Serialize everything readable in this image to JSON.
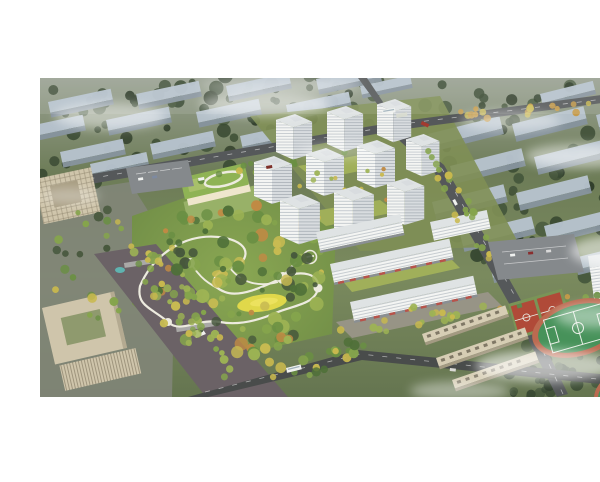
{
  "image": {
    "type": "aerial-architectural-rendering",
    "description": "Bird's-eye architectural rendering of a residential development: a central landscaped park with winding white paths and a yellow lawn, a cluster of white high-rise apartment towers, a kindergarten with a green roof and rooftop oval, mid-rise blocks with ground-floor shops, a school campus with green sports pitch and red courts at lower right, beige office buildings at left, tree-lined boulevards, and hazy rows of existing city blocks fading into mist at the top and right.",
    "render_area": {
      "top_margin_px": 62,
      "bottom_margin_px": 69,
      "width_px": 600,
      "height_px": 319
    }
  },
  "scene": {
    "features": {
      "residential_towers": 10,
      "midrise_shop_blocks": 4,
      "hazy_city_slabs_left": 16,
      "hazy_city_slabs_right": 18,
      "kindergarten": 1,
      "office_buildings": 3,
      "sports_pitches": 2,
      "basketball_courts": 2,
      "school_classroom_blocks": 3,
      "parking_lots": 2,
      "central_park": 1
    },
    "tree_clusters": [
      {
        "name": "haze-left",
        "cx": 160,
        "cy": 112,
        "rx": 185,
        "ry": 52,
        "rot": -8,
        "count": 55,
        "rmin": 3,
        "rmax": 8,
        "colors": [
          "dark_tree_1",
          "dark_tree_2",
          "dark_tree_3"
        ]
      },
      {
        "name": "haze-top",
        "cx": 300,
        "cy": 78,
        "rx": 300,
        "ry": 16,
        "rot": 0,
        "count": 40,
        "rmin": 3,
        "rmax": 7,
        "colors": [
          "dark_tree_1",
          "dark_tree_2",
          "dark_tree_3"
        ]
      },
      {
        "name": "haze-right",
        "cx": 505,
        "cy": 175,
        "rx": 115,
        "ry": 95,
        "rot": 0,
        "count": 60,
        "rmin": 3,
        "rmax": 8,
        "colors": [
          "dark_tree_1",
          "dark_tree_2",
          "dark_tree_3"
        ]
      },
      {
        "name": "corner-bottom-right",
        "cx": 530,
        "cy": 352,
        "rx": 85,
        "ry": 30,
        "rot": -5,
        "count": 32,
        "rmin": 3,
        "rmax": 7,
        "colors": [
          "dark_tree_1",
          "dark_tree_2",
          "dark_tree_3"
        ]
      },
      {
        "name": "park",
        "cx": 196,
        "cy": 262,
        "rx": 92,
        "ry": 78,
        "rot": 0,
        "count": 110,
        "rmin": 2.5,
        "rmax": 7,
        "colors": [
          "park_green_1",
          "park_green_2",
          "park_green_3",
          "park_green_4",
          "park_yellow",
          "park_orange",
          "dark_tree_3"
        ]
      },
      {
        "name": "boulevard",
        "cx": 150,
        "cy": 302,
        "rx": 17,
        "ry": 88,
        "rot": -39,
        "count": 36,
        "rmin": 2.5,
        "rmax": 4.5,
        "colors": [
          "street_tree_yellow",
          "park_green_4",
          "park_green_3"
        ]
      },
      {
        "name": "right-road-trees",
        "cx": 420,
        "cy": 190,
        "rx": 11,
        "ry": 70,
        "rot": -28,
        "count": 22,
        "rmin": 2.5,
        "rmax": 4,
        "colors": [
          "street_tree_yellow",
          "park_green_3"
        ]
      },
      {
        "name": "top-right-road-trees",
        "cx": 485,
        "cy": 95,
        "rx": 85,
        "ry": 7,
        "rot": -4,
        "count": 16,
        "rmin": 2.5,
        "rmax": 4,
        "colors": [
          "street_tree_orange",
          "street_tree_yellow"
        ]
      },
      {
        "name": "shops-street-trees",
        "cx": 370,
        "cy": 302,
        "rx": 78,
        "ry": 10,
        "rot": -11,
        "count": 18,
        "rmin": 2.5,
        "rmax": 4.2,
        "colors": [
          "street_tree_yellow",
          "park_green_4"
        ]
      },
      {
        "name": "site-top-trees",
        "cx": 235,
        "cy": 152,
        "rx": 85,
        "ry": 10,
        "rot": -9,
        "count": 16,
        "rmin": 2.5,
        "rmax": 4,
        "colors": [
          "park_green_3",
          "street_tree_yellow",
          "park_green_2"
        ]
      },
      {
        "name": "courtyard-dots",
        "cx": 305,
        "cy": 176,
        "rx": 55,
        "ry": 28,
        "rot": -10,
        "count": 18,
        "rmin": 1.8,
        "rmax": 3,
        "colors": [
          "street_tree_yellow",
          "park_orange",
          "park_green_4"
        ]
      },
      {
        "name": "plaza-left-trees",
        "cx": 55,
        "cy": 250,
        "rx": 45,
        "ry": 60,
        "rot": 0,
        "count": 24,
        "rmin": 2.5,
        "rmax": 5,
        "colors": [
          "park_green_2",
          "park_green_3",
          "street_tree_yellow",
          "dark_tree_3"
        ]
      },
      {
        "name": "sports-perimeter-trees",
        "cx": 520,
        "cy": 282,
        "rx": 70,
        "ry": 12,
        "rot": -12,
        "count": 14,
        "rmin": 2.5,
        "rmax": 4.5,
        "colors": [
          "park_green_2",
          "park_green_3",
          "street_tree_orange"
        ]
      },
      {
        "name": "bottom-center-trees",
        "cx": 275,
        "cy": 345,
        "rx": 60,
        "ry": 16,
        "rot": -14,
        "count": 20,
        "rmin": 3,
        "rmax": 5.5,
        "colors": [
          "park_green_2",
          "park_green_1",
          "park_green_3",
          "street_tree_yellow"
        ]
      }
    ]
  },
  "palette": {
    "background": "#ffffff",
    "base_top": "#99a192",
    "base_mid": "#6d7c57",
    "base_low": "#7a8a5e",
    "base_deep": "#657550",
    "dark_tree_1": "#3a4a33",
    "dark_tree_2": "#2f3d2a",
    "dark_tree_3": "#46573c",
    "park_green_1": "#4f7038",
    "park_green_2": "#6a8f43",
    "park_green_3": "#85a44c",
    "park_green_4": "#9db354",
    "park_yellow": "#c8bb52",
    "park_orange": "#c08a44",
    "lawn_yellow": "#e0d84a",
    "lawn_yellow_light": "#ece25e",
    "path_white": "#edebdf",
    "road_asphalt": "#55585a",
    "road_dark": "#494c4b",
    "boulevard_paving": "#6b6266",
    "plaza_paving": "#82867a",
    "sidewalk_paving": "#9b968b",
    "slab_top": "#b7c3ce",
    "slab_side": "#87949e",
    "tower_roof": "#dfe3e4",
    "tower_face": "#f4f5f3",
    "tower_floor_line": "#c2c8cd",
    "tower_side": "#d8dcdf",
    "tower_side_line": "#aeb5bb",
    "school_roof_green": "#8fb355",
    "school_roof_green2": "#a8c06a",
    "school_facade": "#efe6cc",
    "school_yard": "#9ab269",
    "office_beige": "#cfc5ab",
    "office_beige_dark": "#a89d82",
    "office_fin": "#9a9078",
    "courtyard_green": "#a2b15a",
    "pitch_green": "#47925a",
    "track_red": "#bb6a50",
    "court_red": "#b04a38",
    "court_base": "#7a9457",
    "line_white": "#e9efe7",
    "parking_gray": "#85898c",
    "shop_red": "#b8534a",
    "street_tree_yellow": "#c9b94e",
    "street_tree_orange": "#c59a48",
    "water_blue": "#5fb3b0",
    "vehicle_white": "#eff1ef",
    "vehicle_red": "#a33b30",
    "mist_white": "#ffffff"
  }
}
